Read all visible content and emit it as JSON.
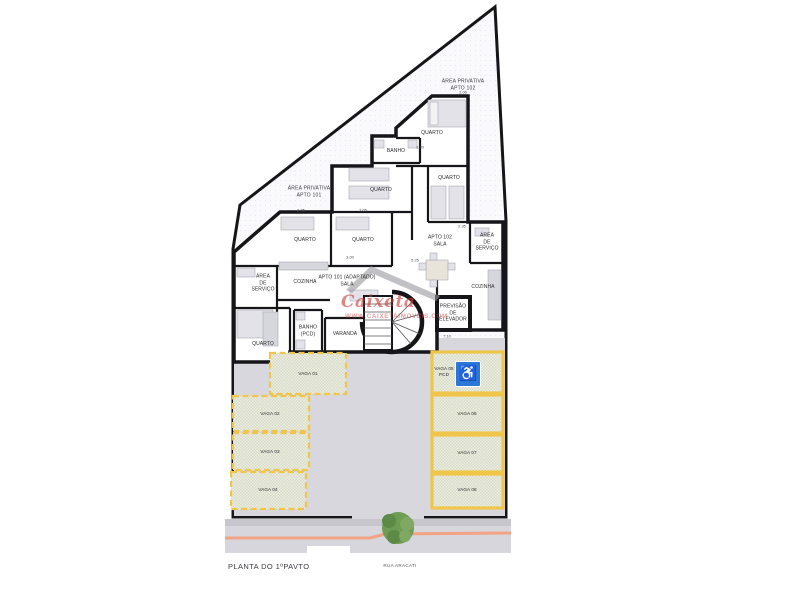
{
  "page": {
    "plan_title": "PLANTA DO 1ºPAVTO",
    "street_name": "RUA ARACATI"
  },
  "watermark": {
    "brand": "Caixeta",
    "url": "WWW.CAIXETAIMOVEIS.COM"
  },
  "private_areas": {
    "apto102": "ÁREA PRIVATIVA\nAPTO 102",
    "apto101": "ÁREA PRIVATIVA\nAPTO 101"
  },
  "rooms": [
    {
      "label": "QUARTO"
    },
    {
      "label": "QUARTO"
    },
    {
      "label": "BANHO"
    },
    {
      "label": "QUARTO"
    },
    {
      "label": "QUARTO"
    },
    {
      "label": "QUARTO"
    },
    {
      "label": "COZINHA"
    },
    {
      "label": "ÁREA\nDE\nSERVIÇO"
    },
    {
      "label": "APTO 101 (ADAPTADO)\nSALA"
    },
    {
      "label": "APTO 102\nSALA"
    },
    {
      "label": "ÁREA\nDE\nSERVIÇO"
    },
    {
      "label": "COZINHA"
    },
    {
      "label": "PREVISÃO\nDE\nELEVADOR"
    },
    {
      "label": "QUARTO"
    },
    {
      "label": "BANHO\n(PCD)"
    },
    {
      "label": "VARANDA"
    }
  ],
  "parking": {
    "left_spots": [
      {
        "label": "VAGA 01"
      },
      {
        "label": "VAGA 02"
      },
      {
        "label": "VAGA 03"
      },
      {
        "label": "VAGA 04"
      }
    ],
    "right_spots": [
      {
        "label": "VAGA 05\nPCD"
      },
      {
        "label": "VAGA 06"
      },
      {
        "label": "VAGA 07"
      },
      {
        "label": "VAGA 08"
      }
    ],
    "accessible_glyph": "♿"
  },
  "dimensions": [
    {
      "label": "2.06"
    },
    {
      "label": "3.20"
    },
    {
      "label": "2.35"
    },
    {
      "label": "2.05"
    },
    {
      "label": "3.05"
    },
    {
      "label": "3.00"
    },
    {
      "label": "5.25"
    },
    {
      "label": "7.10"
    }
  ],
  "colors": {
    "wall": "#15151a",
    "site_fill": "#fafafc",
    "parking_lot": "#d8d7dd",
    "vaga_fill": "#edeee3",
    "vaga_border": "#f0c64a",
    "accessible_blue": "#2b78d9",
    "curb_line": "#f2a285",
    "tree_green": "#6f9c55",
    "watermark_red": "#c93c37"
  }
}
